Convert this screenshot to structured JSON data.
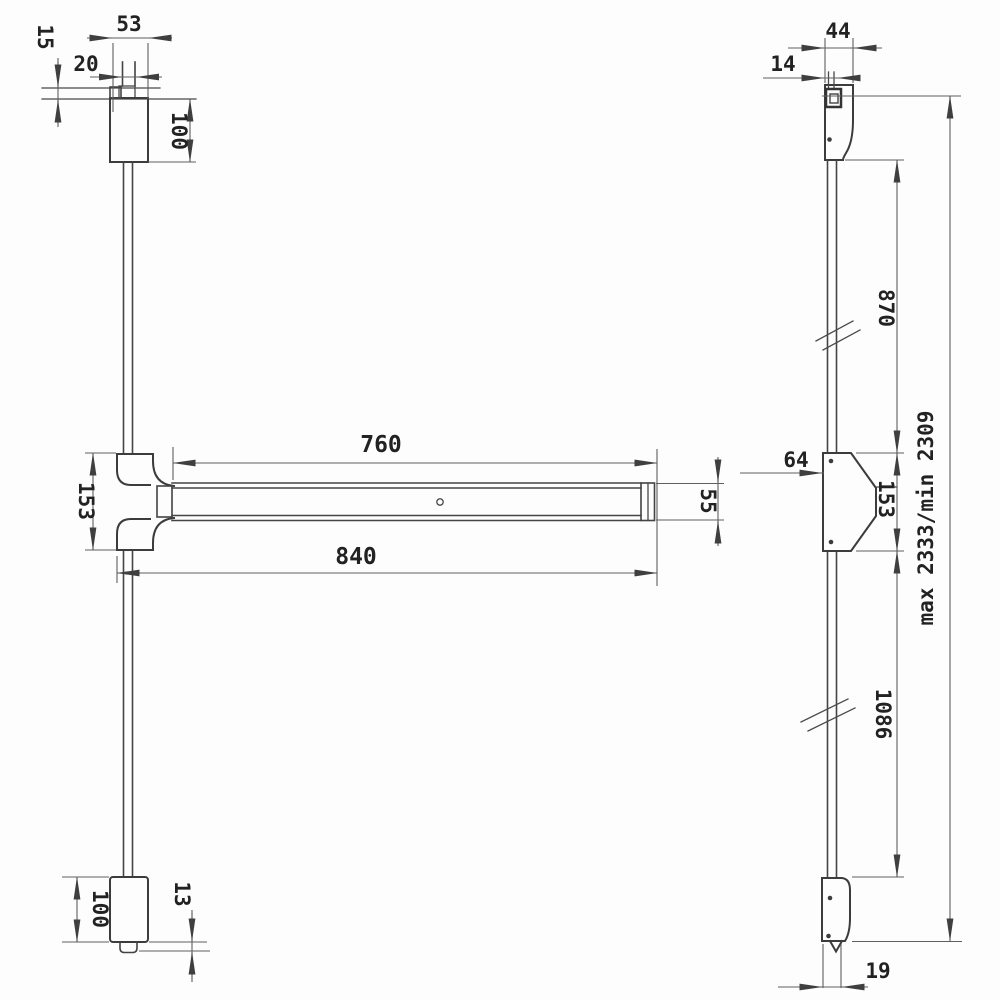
{
  "drawing": {
    "type": "technical-dimension-drawing",
    "subject": "panic exit device with vertical rods - front and side views",
    "line_color": "#3c3c3c",
    "dim_color": "#5f5f5f",
    "front": {
      "top_width": "53",
      "bolt_width": "20",
      "bolt_offset": "15",
      "top_latch_height": "100",
      "center_case_height": "153",
      "bar_length": "760",
      "overall_width": "840",
      "bar_height": "55",
      "bottom_latch_height": "100",
      "foot_offset": "13"
    },
    "side": {
      "latch_depth": "44",
      "bolt_depth": "14",
      "upper_rod_length": "870",
      "case_offset": "64",
      "case_height": "153",
      "lower_rod_length": "1086",
      "overall_height": "max 2333/min 2309",
      "rod_width": "19"
    }
  }
}
